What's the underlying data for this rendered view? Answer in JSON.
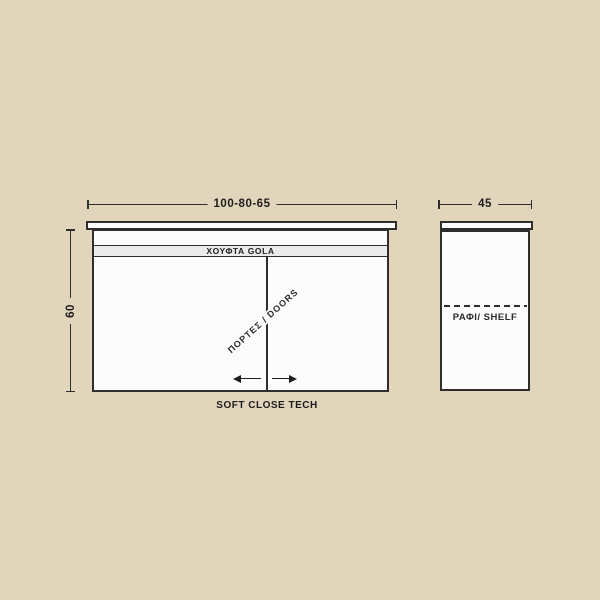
{
  "drawing": {
    "type": "cabinet-technical-drawing",
    "colors": {
      "background": "#e1d5bb",
      "cabinet_fill": "#fcfcfc",
      "gola_band_fill": "#ebebeb",
      "line": "#2e2e2e",
      "text": "#1d1d1d"
    },
    "front_view": {
      "width_dimension": "100-80-65",
      "height_dimension": "60",
      "gola_label": "ΧΟΥΦΤΑ GOLA",
      "doors_label": "ΠΟΡΤΕΣ / DOORS",
      "tech_caption": "SOFT CLOSE TECH"
    },
    "side_view": {
      "depth_dimension": "45",
      "shelf_label": "ΡΑΦΙ/ SHELF"
    }
  }
}
